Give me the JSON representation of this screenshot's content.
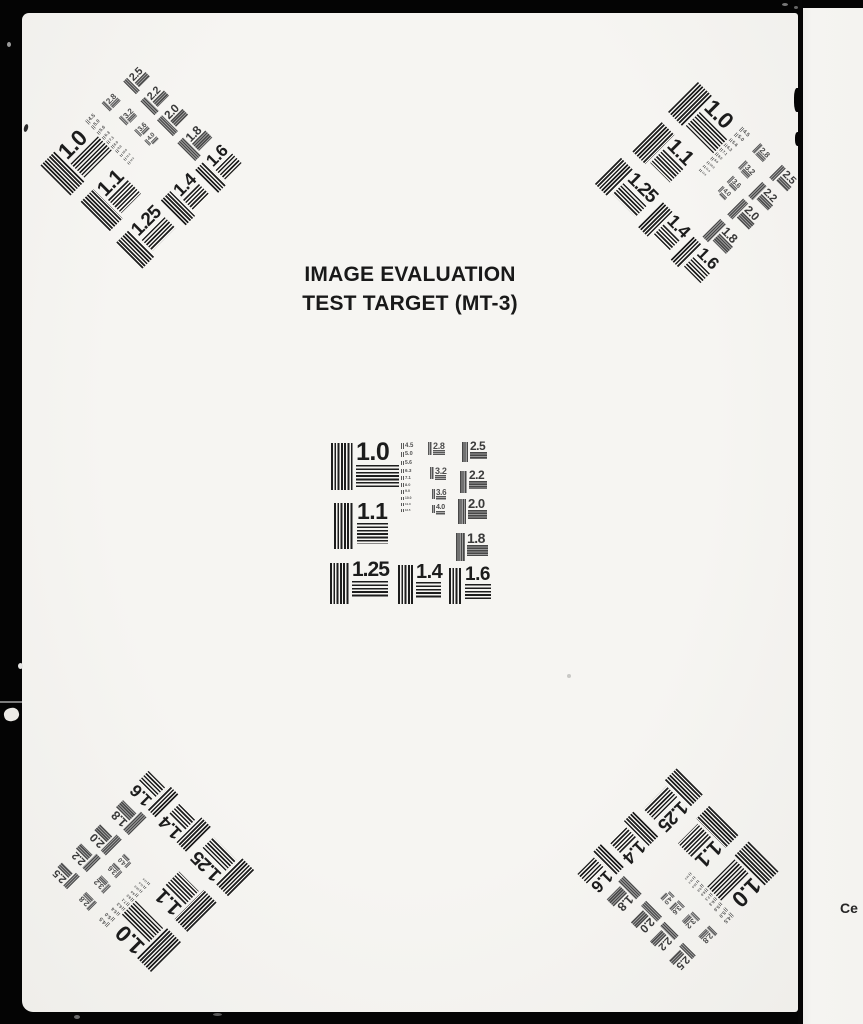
{
  "title": {
    "line1": "IMAGE EVALUATION",
    "line2": "TEST TARGET (MT-3)"
  },
  "pattern": {
    "large": [
      "1.0",
      "1.1",
      "1.25",
      "1.4",
      "1.6"
    ],
    "medium": [
      "2.5",
      "2.2",
      "2.0",
      "1.8"
    ],
    "small": [
      "2.8",
      "3.2",
      "3.6",
      "4.0"
    ],
    "tiny": [
      "4.5",
      "5.0",
      "5.6",
      "6.3",
      "7.1",
      "8.0",
      "9.0",
      "10.0",
      "11.0",
      "12.5"
    ]
  },
  "edge_note": "Ce",
  "colors": {
    "background": "#040404",
    "paper": "#f4f3f0",
    "ink": "#1c1c1c",
    "halftone_gray": "#4a4a4a"
  }
}
